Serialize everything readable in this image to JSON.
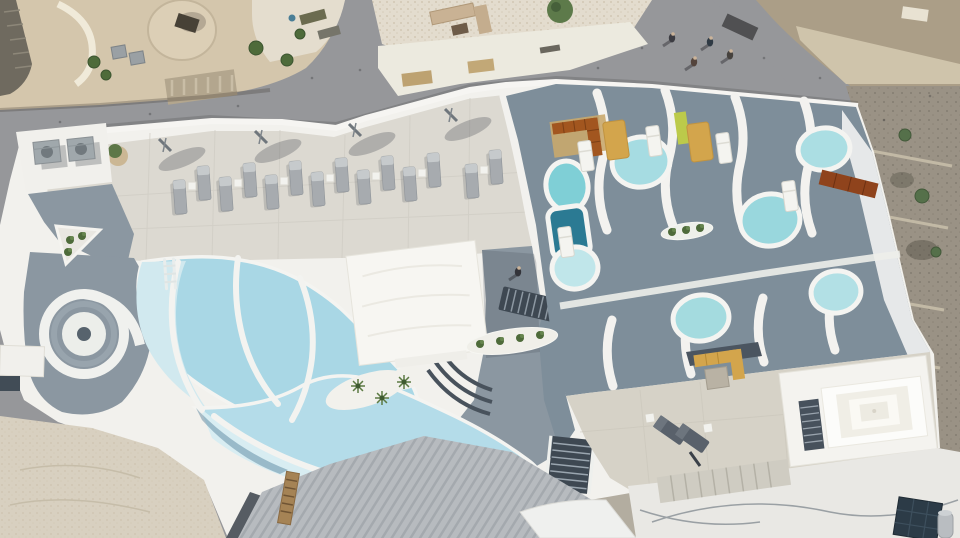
{
  "meta": {
    "caption": "Aerial top-down drone view of a white cliffside resort rooftop with a free-form swimming pool, private plunge pools, rows of sun loungers, whitewashed village buildings and narrow streets",
    "type": "aerial-photograph"
  },
  "palette": {
    "street": "#96979a",
    "tan_building": "#d4c6ac",
    "pebble": "#e3dcce",
    "dirt": "#ab9e87",
    "rock": "#9a9285",
    "white_roof": "#f2f1ed",
    "white_bright": "#fbfbf8",
    "terrace_tile": "#dcd9d1",
    "terrace_warm": "#d6d2c7",
    "deck_gray": "#8b97a1",
    "deck_gray_dark": "#7e8e9a",
    "stair_dark": "#3e4852",
    "pool_upper": "#a9d7e5",
    "pool_lower": "#b4dce9",
    "pool_pale": "#d1e9ef",
    "pool_pale2": "#d8edf2",
    "pool_rim": "#f4f4f1",
    "pool_teal_dark": "#2b7a93",
    "mustard": "#d3a54c",
    "terracotta": "#a2561f",
    "green_accent": "#bcca4a",
    "foliage": "#4e6b3a",
    "lounger_gray": "#a7abaf",
    "lounger_pad": "#c6cacc",
    "corrugated": "#b7bbbf",
    "paving_old": "#d8d0c0",
    "roofs_br": "#e9e8e4",
    "solar_dark": "#2c3b47",
    "shadow": "rgba(45,52,60,0.26)"
  },
  "scene": {
    "counts": {
      "sun_loungers": 14,
      "plunge_pools": 8,
      "pedestrians": 4,
      "umbrellas": 4
    },
    "sun_loungers": [
      {
        "x": 180,
        "y": 196
      },
      {
        "x": 204,
        "y": 182
      },
      {
        "x": 226,
        "y": 193
      },
      {
        "x": 250,
        "y": 179
      },
      {
        "x": 272,
        "y": 191
      },
      {
        "x": 296,
        "y": 177
      },
      {
        "x": 318,
        "y": 188
      },
      {
        "x": 342,
        "y": 174
      },
      {
        "x": 364,
        "y": 186
      },
      {
        "x": 388,
        "y": 172
      },
      {
        "x": 410,
        "y": 183
      },
      {
        "x": 434,
        "y": 169
      },
      {
        "x": 472,
        "y": 180
      },
      {
        "x": 496,
        "y": 166
      }
    ],
    "side_tables": [
      {
        "x": 192,
        "y": 186
      },
      {
        "x": 238,
        "y": 183
      },
      {
        "x": 284,
        "y": 181
      },
      {
        "x": 330,
        "y": 178
      },
      {
        "x": 376,
        "y": 176
      },
      {
        "x": 422,
        "y": 173
      },
      {
        "x": 484,
        "y": 170
      }
    ],
    "umbrellas": [
      {
        "x": 162,
        "y": 142
      },
      {
        "x": 258,
        "y": 134
      },
      {
        "x": 352,
        "y": 127
      },
      {
        "x": 448,
        "y": 112
      }
    ],
    "plunge_pools": [
      {
        "shape": "ellipse",
        "cx": 567,
        "cy": 186,
        "rx": 21,
        "ry": 25,
        "rot": -8,
        "fill": "#7fcfd6"
      },
      {
        "shape": "rect",
        "cx": 569,
        "cy": 232,
        "w": 38,
        "h": 50,
        "rot": -8,
        "fill": "#2b7a93"
      },
      {
        "shape": "ellipse",
        "cx": 641,
        "cy": 162,
        "rx": 29,
        "ry": 25,
        "rot": -8,
        "fill": "#a6dce2"
      },
      {
        "shape": "ellipse",
        "cx": 770,
        "cy": 220,
        "rx": 30,
        "ry": 26,
        "rot": -8,
        "fill": "#99d7dd"
      },
      {
        "shape": "ellipse",
        "cx": 824,
        "cy": 149,
        "rx": 26,
        "ry": 21,
        "rot": -8,
        "fill": "#abdee3"
      },
      {
        "shape": "ellipse",
        "cx": 575,
        "cy": 268,
        "rx": 23,
        "ry": 21,
        "rot": -8,
        "fill": "#c0e6ea"
      },
      {
        "shape": "ellipse",
        "cx": 701,
        "cy": 318,
        "rx": 28,
        "ry": 23,
        "rot": -8,
        "fill": "#a4dbdf"
      },
      {
        "shape": "ellipse",
        "cx": 836,
        "cy": 292,
        "rx": 25,
        "ry": 21,
        "rot": -8,
        "fill": "#b2e0e5"
      }
    ],
    "white_loungers": [
      {
        "x": 586,
        "y": 156
      },
      {
        "x": 654,
        "y": 141
      },
      {
        "x": 724,
        "y": 148
      },
      {
        "x": 790,
        "y": 196
      },
      {
        "x": 566,
        "y": 242
      }
    ],
    "mustard_mats": [
      {
        "x": 616,
        "y": 140
      },
      {
        "x": 700,
        "y": 142
      }
    ],
    "deck_loungers": [
      {
        "x": 670,
        "y": 430,
        "a": -55
      },
      {
        "x": 692,
        "y": 438,
        "a": -55
      }
    ],
    "pedestrians": [
      {
        "x": 672,
        "y": 38,
        "c": "#3c3c42"
      },
      {
        "x": 694,
        "y": 62,
        "c": "#54443c"
      },
      {
        "x": 710,
        "y": 42,
        "c": "#2f3a44"
      },
      {
        "x": 730,
        "y": 55,
        "c": "#46423e"
      }
    ],
    "guest": {
      "x": 518,
      "y": 272,
      "c": "#33343a"
    },
    "palms": [
      {
        "x": 358,
        "y": 386
      },
      {
        "x": 382,
        "y": 398
      },
      {
        "x": 404,
        "y": 382
      }
    ],
    "plant_tufts": [
      {
        "x": 480,
        "y": 344
      },
      {
        "x": 500,
        "y": 341
      },
      {
        "x": 520,
        "y": 338
      },
      {
        "x": 540,
        "y": 335
      },
      {
        "x": 672,
        "y": 232
      },
      {
        "x": 686,
        "y": 230
      },
      {
        "x": 700,
        "y": 228
      },
      {
        "x": 70,
        "y": 240
      },
      {
        "x": 82,
        "y": 236
      },
      {
        "x": 68,
        "y": 252
      }
    ],
    "shrubs": [
      {
        "x": 905,
        "y": 135,
        "r": 6
      },
      {
        "x": 922,
        "y": 196,
        "r": 7
      },
      {
        "x": 936,
        "y": 252,
        "r": 5
      },
      {
        "x": 897,
        "y": 386,
        "r": 5
      },
      {
        "x": 931,
        "y": 421,
        "r": 4
      }
    ],
    "old_town_greens": [
      {
        "x": 256,
        "y": 48,
        "r": 7
      },
      {
        "x": 287,
        "y": 60,
        "r": 6
      },
      {
        "x": 300,
        "y": 34,
        "r": 5
      },
      {
        "x": 94,
        "y": 62,
        "r": 6
      },
      {
        "x": 106,
        "y": 75,
        "r": 5
      }
    ],
    "street_speckles": [
      [
        60,
        122
      ],
      [
        150,
        114
      ],
      [
        238,
        106
      ],
      [
        312,
        78
      ],
      [
        420,
        110
      ],
      [
        500,
        100
      ],
      [
        598,
        68
      ],
      [
        642,
        48
      ],
      [
        764,
        58
      ],
      [
        820,
        78
      ],
      [
        884,
        120
      ],
      [
        930,
        96
      ],
      [
        560,
        92
      ],
      [
        360,
        70
      ]
    ],
    "ac_units": [
      {
        "x": 47,
        "y": 152
      },
      {
        "x": 81,
        "y": 149
      }
    ]
  }
}
